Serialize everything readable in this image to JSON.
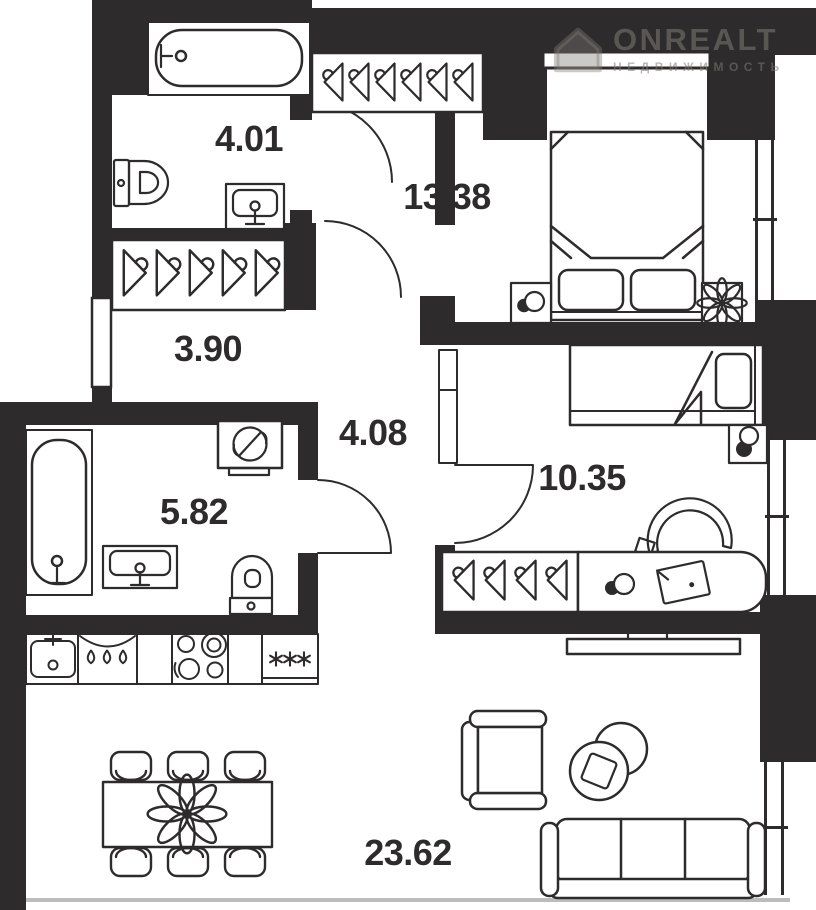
{
  "watermark": {
    "brand": "ONREALT",
    "subtitle": "НЕДВИЖИМОСТЬ"
  },
  "rooms": [
    {
      "name": "bathroom-top",
      "area": "4.01"
    },
    {
      "name": "bedroom-master",
      "area": "13.38"
    },
    {
      "name": "hallway",
      "area": "3.90"
    },
    {
      "name": "corridor",
      "area": "4.08"
    },
    {
      "name": "bathroom-main",
      "area": "5.82"
    },
    {
      "name": "bedroom-second",
      "area": "10.35"
    },
    {
      "name": "kitchen-living",
      "area": "23.62"
    }
  ],
  "colors": {
    "wall": "#2e2b2c",
    "floor": "#ffffff",
    "facade_line": "#bcbcbc",
    "watermark": "rgba(128,122,117,0.55)"
  },
  "icons": [
    "house-logo-icon",
    "bathtub-icon",
    "toilet-icon",
    "washbasin-icon",
    "washing-machine-icon",
    "hanger-icon",
    "double-bed-icon",
    "single-bed-icon",
    "nightstand-lamp-icon",
    "nightstand-flower-icon",
    "desk-icon",
    "desk-chair-icon",
    "laptop-icon",
    "tv-icon",
    "kitchen-sink-icon",
    "dishwasher-icon",
    "stove-icon",
    "fridge-freezer-icon",
    "dining-table-icon",
    "chair-icon",
    "armchair-icon",
    "coffee-table-icon",
    "sofa-icon",
    "door-arc-icon",
    "window-icon"
  ]
}
